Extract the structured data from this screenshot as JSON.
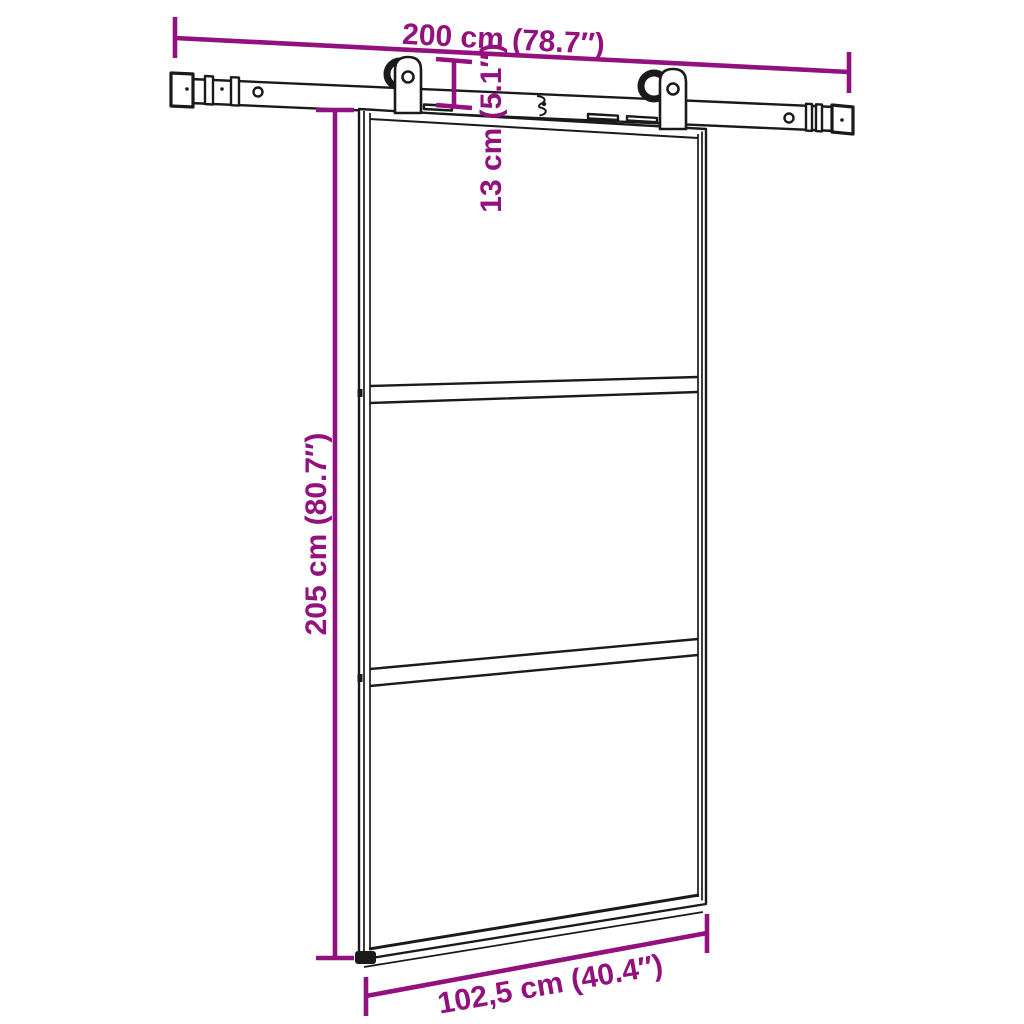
{
  "diagram": {
    "kind": "sliding-door-dimension-diagram",
    "dimensions": {
      "track_length": "200 cm (78.7″)",
      "hardware_drop": "13 cm (5.1″)",
      "door_height": "205 cm (80.7″)",
      "door_width": "102,5 cm (40.4″)"
    },
    "colors": {
      "dimension": "#92117E",
      "line_art": "#1a1a1a",
      "background": "#ffffff"
    }
  }
}
